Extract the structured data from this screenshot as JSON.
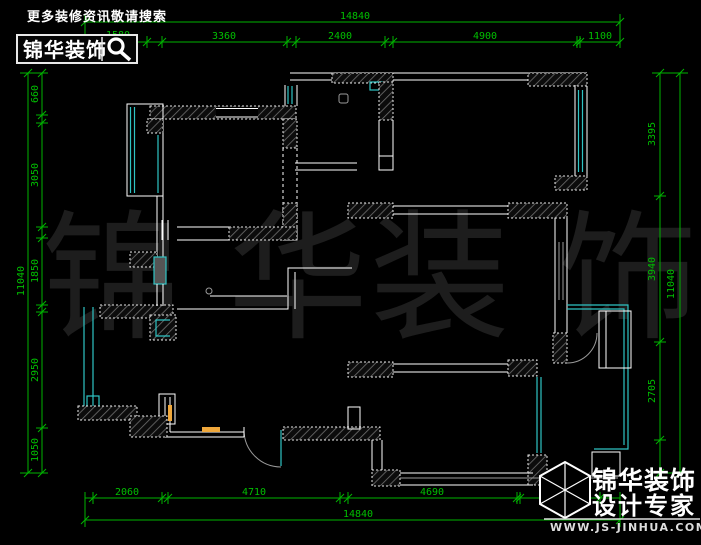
{
  "header": {
    "tagline": "更多装修资讯敬请搜索",
    "brand": "锦华装饰",
    "search_icon": "magnifier-icon"
  },
  "footer": {
    "brand": "锦华装饰",
    "slogan": "设计专家",
    "website": "WWW.JS-JINHUA.COM",
    "logo_icon": "cube-logo-icon"
  },
  "watermark": {
    "chars": [
      "锦",
      "华",
      "装",
      "饰"
    ]
  },
  "dims": {
    "top": {
      "overall": "14840",
      "segments": [
        "1580",
        "3360",
        "2400",
        "4900",
        "1100"
      ]
    },
    "bottom": {
      "overall": "14840",
      "segments": [
        "2060",
        "4710",
        "4690",
        "2230"
      ]
    },
    "left": {
      "overall": "11040",
      "segments": [
        "660",
        "3050",
        "1850",
        "2950",
        "1050"
      ]
    },
    "right": {
      "overall": "11040",
      "segments": [
        "3395",
        "3940",
        "2705"
      ]
    }
  },
  "colors": {
    "background": "#000000",
    "dimension_green": "#00b400",
    "wall_white": "#ffffff",
    "window_cyan": "#2fc4c4",
    "furniture_orange": "#f0a83c",
    "watermark_gray": "#1d1d1d"
  }
}
